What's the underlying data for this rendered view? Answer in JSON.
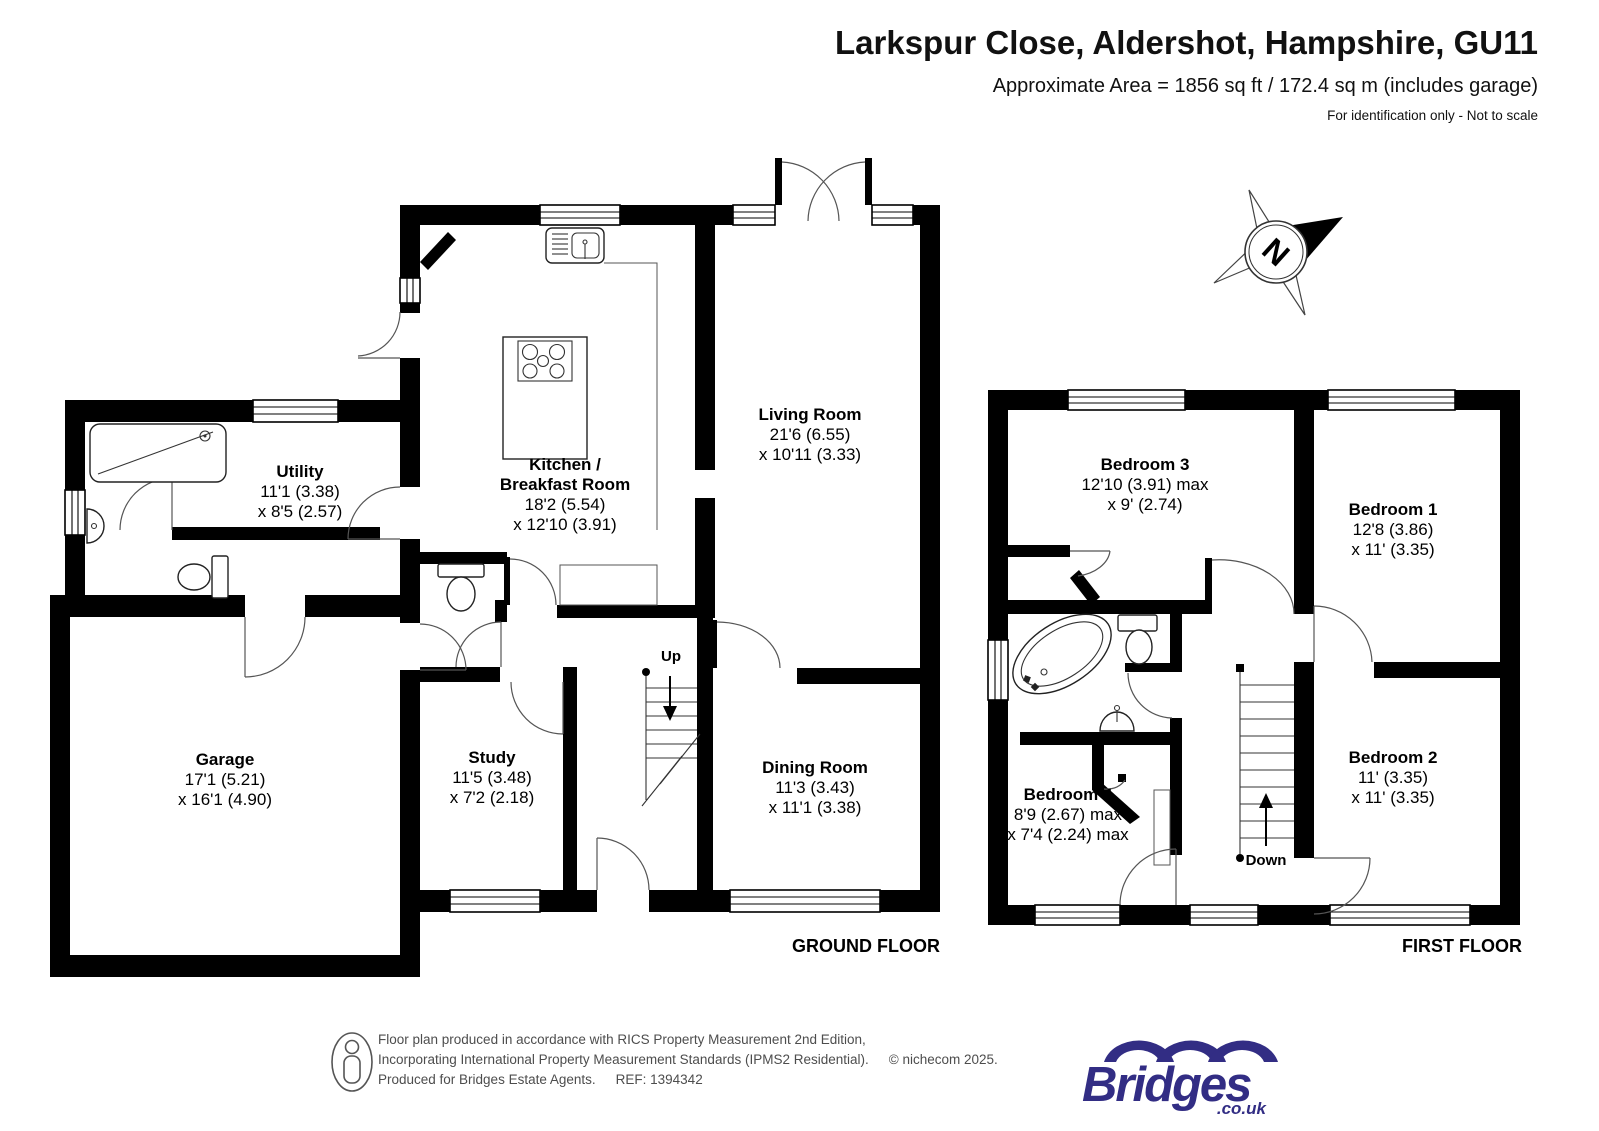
{
  "header": {
    "title": "Larkspur Close, Aldershot, Hampshire, GU11",
    "subtitle": "Approximate Area = 1856 sq ft / 172.4 sq m (includes garage)",
    "note": "For identification only - Not to scale"
  },
  "compass": {
    "letter": "N"
  },
  "floors": {
    "ground": {
      "label": "GROUND FLOOR",
      "stairs_label": "Up",
      "rooms": {
        "living": {
          "name": "Living Room",
          "dim1": "21'6 (6.55)",
          "dim2": "x 10'11 (3.33)"
        },
        "kitchen": {
          "name1": "Kitchen /",
          "name2": "Breakfast Room",
          "dim1": "18'2 (5.54)",
          "dim2": "x 12'10 (3.91)"
        },
        "utility": {
          "name": "Utility",
          "dim1": "11'1 (3.38)",
          "dim2": "x 8'5 (2.57)"
        },
        "garage": {
          "name": "Garage",
          "dim1": "17'1 (5.21)",
          "dim2": "x 16'1 (4.90)"
        },
        "study": {
          "name": "Study",
          "dim1": "11'5 (3.48)",
          "dim2": "x 7'2 (2.18)"
        },
        "dining": {
          "name": "Dining Room",
          "dim1": "11'3 (3.43)",
          "dim2": "x 11'1 (3.38)"
        }
      }
    },
    "first": {
      "label": "FIRST FLOOR",
      "stairs_label": "Down",
      "rooms": {
        "bedroom1": {
          "name": "Bedroom 1",
          "dim1": "12'8 (3.86)",
          "dim2": "x 11' (3.35)"
        },
        "bedroom2": {
          "name": "Bedroom 2",
          "dim1": "11' (3.35)",
          "dim2": "x 11' (3.35)"
        },
        "bedroom3": {
          "name": "Bedroom 3",
          "dim1": "12'10 (3.91) max",
          "dim2": "x 9' (2.74)"
        },
        "bedroom4": {
          "name": "Bedroom 4",
          "dim1": "8'9 (2.67) max",
          "dim2": "x 7'4 (2.24) max"
        }
      }
    }
  },
  "footer": {
    "line1": "Floor plan produced in accordance with RICS Property Measurement 2nd Edition,",
    "line2": "Incorporating International Property Measurement Standards (IPMS2 Residential).",
    "copyright": "© nichecom 2025.",
    "line3": "Produced for Bridges Estate Agents.",
    "ref": "REF: 1394342",
    "logo": {
      "text": "Bridges",
      "suffix": ".co.uk",
      "color": "#322d84"
    }
  }
}
